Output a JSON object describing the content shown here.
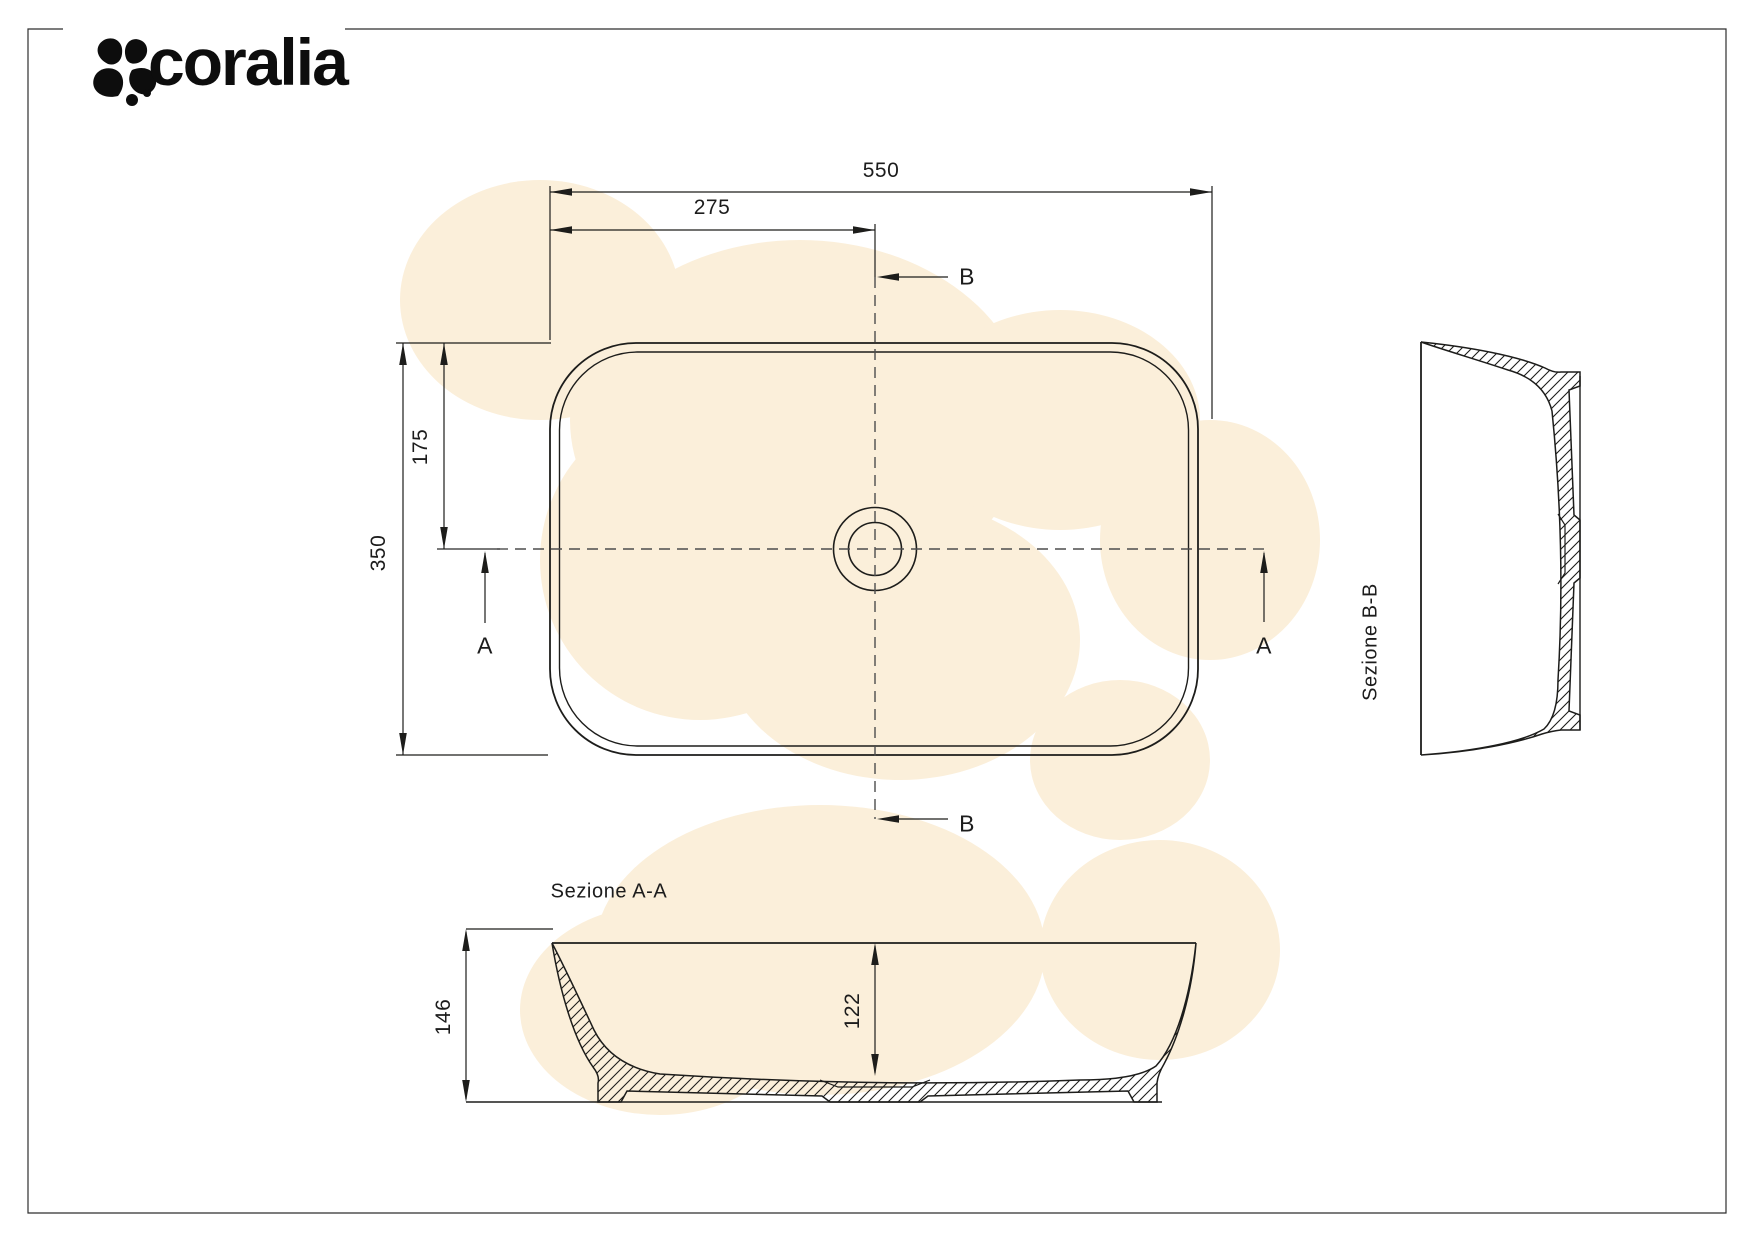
{
  "brand": {
    "name": "coralia"
  },
  "colors": {
    "blob": "#fbefda",
    "line": "#1d1d1b",
    "dash": "#4d4d4d"
  },
  "top_view": {
    "dim_width": "550",
    "dim_half_width": "275",
    "dim_height": "350",
    "dim_half_height": "175",
    "marker_a_left": "A",
    "marker_a_right": "A",
    "marker_b_top": "B",
    "marker_b_bottom": "B"
  },
  "section_aa": {
    "title": "Sezione A-A",
    "dim_total_height": "146",
    "dim_inner_depth": "122"
  },
  "section_bb": {
    "title": "Sezione B-B"
  }
}
